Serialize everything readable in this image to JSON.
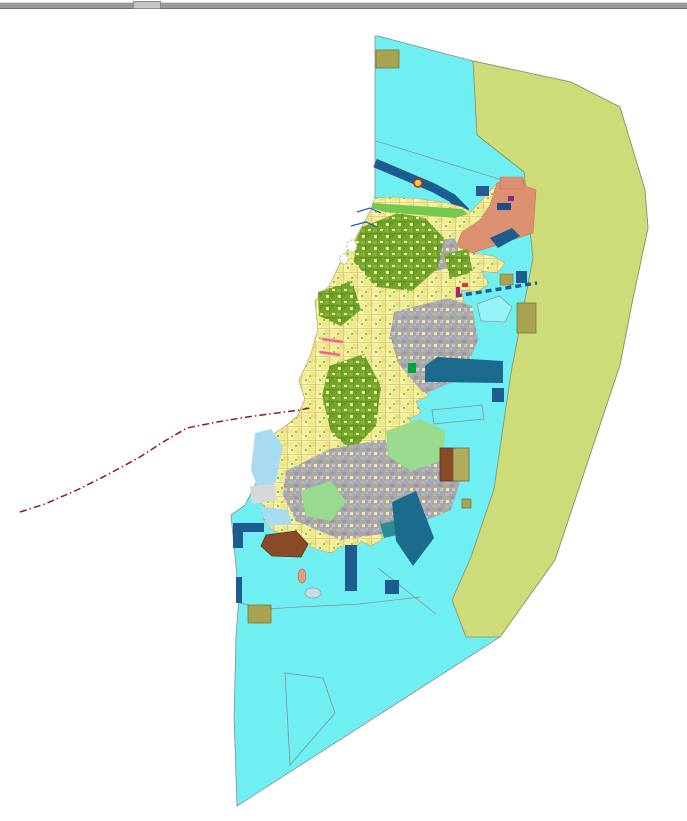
{
  "window": {
    "background": "#ffffff",
    "splitter": {
      "top": 2,
      "height": 5,
      "color": "#9a9a9a",
      "highlight": "#d8d8d8",
      "shadow": "#6f6f6f",
      "handle": {
        "x": 133,
        "width": 26,
        "color": "#c6c6c6",
        "border": "#8a8a8a"
      }
    }
  },
  "map": {
    "width": 687,
    "height": 821,
    "colors": {
      "water": "#70efF2",
      "buffer_zone": "#cdDC78",
      "parcel_yellow": "#f4f09b",
      "forest_green": "#74a62c",
      "urban_gray": "#aba6ab",
      "salmon_zone": "#db9070",
      "navy_pier": "#1d5c8e",
      "harbor_teal": "#1d6a8f",
      "khaki_block": "#a9a351",
      "brown_block": "#8a4a28",
      "light_green": "#98db8c",
      "light_blue": "#a6dbf2",
      "boundary_red": "#8b1a1a",
      "outline_gray": "#8c8c8c"
    },
    "patterns": [
      {
        "id": "parcelYellow",
        "w": 14,
        "h": 14,
        "base": "#f4f09b",
        "cells": [
          {
            "x": 0,
            "y": 0,
            "w": 7,
            "h": 5,
            "f": "#ede88e"
          },
          {
            "x": 8,
            "y": 2,
            "w": 5,
            "h": 6,
            "f": "#fbf7ad"
          },
          {
            "x": 3,
            "y": 8,
            "w": 6,
            "h": 5,
            "f": "#e8e187"
          },
          {
            "x": 10,
            "y": 9,
            "w": 4,
            "h": 4,
            "f": "#f0ec9a"
          },
          {
            "x": 0,
            "y": 6,
            "w": 14,
            "h": 0.7,
            "f": "#d9c070"
          },
          {
            "x": 7,
            "y": 0,
            "w": 0.7,
            "h": 14,
            "f": "#d9c070"
          },
          {
            "x": 11,
            "y": 1,
            "w": 2,
            "h": 2,
            "f": "#8fbb4a"
          },
          {
            "x": 1,
            "y": 11,
            "w": 2,
            "h": 2,
            "f": "#9cc258"
          }
        ]
      },
      {
        "id": "parcelGreen",
        "w": 12,
        "h": 12,
        "base": "#74a62c",
        "cells": [
          {
            "x": 1,
            "y": 1,
            "w": 4,
            "h": 3,
            "f": "#84b63a"
          },
          {
            "x": 6,
            "y": 5,
            "w": 4,
            "h": 4,
            "f": "#6a9c24"
          },
          {
            "x": 2,
            "y": 7,
            "w": 3,
            "h": 3,
            "f": "#f0ec9a"
          },
          {
            "x": 8,
            "y": 1,
            "w": 3,
            "h": 2,
            "f": "#f4f09b"
          },
          {
            "x": 0,
            "y": 5,
            "w": 12,
            "h": 0.6,
            "f": "#5e8c1e"
          },
          {
            "x": 5,
            "y": 0,
            "w": 0.6,
            "h": 12,
            "f": "#5e8c1e"
          }
        ]
      },
      {
        "id": "parcelGray",
        "w": 12,
        "h": 12,
        "base": "#aba6ab",
        "cells": [
          {
            "x": 1,
            "y": 1,
            "w": 4,
            "h": 3,
            "f": "#b8b2b8"
          },
          {
            "x": 6,
            "y": 4,
            "w": 4,
            "h": 3,
            "f": "#9c979c"
          },
          {
            "x": 2,
            "y": 8,
            "w": 3,
            "h": 3,
            "f": "#f0ec9a"
          },
          {
            "x": 8,
            "y": 8,
            "w": 3,
            "h": 3,
            "f": "#c8c2c8"
          },
          {
            "x": 6,
            "y": 0,
            "w": 2,
            "h": 2,
            "f": "#7fd0d8"
          },
          {
            "x": 0,
            "y": 6,
            "w": 2,
            "h": 2,
            "f": "#94c06a"
          }
        ]
      }
    ],
    "shapes": [
      {
        "name": "water-planning-area",
        "type": "polygon",
        "fill": "#70eff2",
        "stroke": "#8c8c8c",
        "sw": 0.8,
        "points": "378,36 473,61 571,82 620,107 645,190 648,228 632,303 620,365 555,560 500,637 237,806 234,717 236,636 239,597 231,515 245,505 259,477 266,439 283,428 297,417 305,399 299,381 311,354 318,329 315,301 330,285 341,261 357,236 371,210 375,198 375,36"
      },
      {
        "name": "coastal-buffer-zone",
        "type": "polygon",
        "fill": "#cddc78",
        "stroke": "#8a8a66",
        "sw": 0.8,
        "points": "473,61 571,82 620,107 645,190 648,228 632,303 620,365 555,560 500,637 466,637 452,600 471,557 494,489 511,373 533,258 524,172 477,135"
      },
      {
        "name": "water-zone-line-north",
        "type": "polyline",
        "fill": "none",
        "stroke": "#8c8c8c",
        "sw": 0.7,
        "points": "376,141 512,183"
      },
      {
        "name": "water-zone-line-south",
        "type": "polyline",
        "fill": "none",
        "stroke": "#8c8c8c",
        "sw": 0.7,
        "points": "240,603 266,609 300,607 360,604 420,597"
      },
      {
        "name": "water-zone-line-southeast",
        "type": "polyline",
        "fill": "none",
        "stroke": "#8c8c8c",
        "sw": 0.7,
        "points": "378,568 436,614"
      },
      {
        "name": "navigation-channel-band",
        "type": "polyline",
        "fill": "none",
        "stroke": "#1d5c8e",
        "sw": 9,
        "points": "375,163 434,188 452,198 466,212"
      },
      {
        "name": "island-parcels-base",
        "type": "polygon",
        "fill": "pattern:parcelYellow",
        "stroke": "#c8a858",
        "sw": 0.6,
        "points": "393,197 420,199 447,203 462,207 471,212 497,183 523,179 525,186 536,190 533,233 509,241 472,253 493,256 505,263 497,273 481,271 489,283 478,292 461,290 464,301 455,306 466,313 459,323 469,331 461,341 452,339 459,353 446,356 453,363 446,373 431,361 426,369 433,381 421,386 429,396 416,401 421,413 409,419 416,431 406,439 413,451 401,459 409,471 396,479 401,489 391,496 396,506 386,513 391,521 379,529 383,539 371,546 361,541 356,549 341,546 331,553 316,549 301,543 286,536 271,529 263,519 269,511 259,501 266,493 256,486 263,479 253,471 261,463 253,456 263,449 256,441 266,439 283,428 297,417 305,399 299,381 311,354 318,329 315,301 330,285 341,261 357,236 371,210 375,198"
      },
      {
        "name": "north-coast-green-strip",
        "type": "polygon",
        "fill": "#72c94e",
        "stroke": "none",
        "sw": 0,
        "points": "372,203 462,209 468,214 455,218 420,215 385,212 372,208"
      },
      {
        "name": "salmon-zone-north",
        "type": "polygon",
        "fill": "#db9070",
        "stroke": "#c07050",
        "sw": 0.5,
        "points": "497,183 523,179 525,186 536,190 533,233 509,241 472,253 456,246 462,232 480,220 490,205"
      },
      {
        "name": "salmon-zone-rect",
        "type": "rect",
        "x": 500,
        "y": 177,
        "w": 23,
        "h": 12,
        "fill": "#db9070",
        "stroke": "#c07050",
        "sw": 0.5
      },
      {
        "name": "urban-blob-north",
        "type": "polygon",
        "fill": "pattern:parcelGray",
        "stroke": "none",
        "sw": 0,
        "points": "420,243 455,238 463,264 432,272"
      },
      {
        "name": "forest-blob-northeast",
        "type": "polygon",
        "fill": "pattern:parcelGreen",
        "stroke": "none",
        "sw": 0,
        "points": "444,254 468,249 473,272 450,279"
      },
      {
        "name": "forest-mass-north",
        "type": "polygon",
        "fill": "pattern:parcelGreen",
        "stroke": "none",
        "sw": 0,
        "points": "362,227 398,213 425,218 444,238 438,268 412,291 376,287 354,262 356,240"
      },
      {
        "name": "forest-blob-midwest",
        "type": "polygon",
        "fill": "pattern:parcelGreen",
        "stroke": "none",
        "sw": 0,
        "points": "318,292 352,281 361,310 341,326 319,316"
      },
      {
        "name": "urban-mass-center",
        "type": "polygon",
        "fill": "pattern:parcelGray",
        "stroke": "none",
        "sw": 0,
        "points": "394,312 448,298 472,306 478,340 462,378 424,394 398,363 390,335"
      },
      {
        "name": "forest-mass-central",
        "type": "polygon",
        "fill": "pattern:parcelGreen",
        "stroke": "none",
        "sw": 0,
        "points": "329,366 364,354 381,386 376,426 352,451 331,432 322,396"
      },
      {
        "name": "urban-mass-south",
        "type": "polygon",
        "fill": "pattern:parcelGray",
        "stroke": "none",
        "sw": 0,
        "points": "286,471 330,449 380,440 432,441 464,470 451,510 401,531 341,540 296,521 283,495"
      },
      {
        "name": "lightgreen-blob-southeast",
        "type": "polygon",
        "fill": "#98db8c",
        "stroke": "none",
        "sw": 0,
        "points": "386,431 420,419 446,431 441,461 411,471 388,456"
      },
      {
        "name": "lightgreen-blob-southwest",
        "type": "polygon",
        "fill": "#98db8c",
        "stroke": "none",
        "sw": 0,
        "points": "301,491 331,481 346,501 331,521 306,516"
      },
      {
        "name": "lightblue-coast-west",
        "type": "polygon",
        "fill": "#a6dbf2",
        "stroke": "none",
        "sw": 0,
        "points": "255,433 271,429 283,446 276,481 263,501 251,470"
      },
      {
        "name": "lightblue-coast-west2",
        "type": "polygon",
        "fill": "#a6dbf2",
        "stroke": "none",
        "sw": 0,
        "points": "259,506 288,510 292,524 268,526"
      },
      {
        "name": "lightgray-flat-patch",
        "type": "polygon",
        "fill": "#d8d8d8",
        "stroke": "none",
        "sw": 0,
        "points": "250,486 275,484 277,500 252,504"
      },
      {
        "name": "teal-coast-patch",
        "type": "polygon",
        "fill": "#2e8b99",
        "stroke": "none",
        "sw": 0,
        "points": "380,524 398,520 402,534 384,538"
      },
      {
        "name": "brown-blob-southwest",
        "type": "polygon",
        "fill": "#8a4a28",
        "stroke": "#5a3018",
        "sw": 0.8,
        "points": "266,535 296,531 308,544 301,557 272,556 261,546"
      },
      {
        "name": "harbor-rect-east",
        "type": "polygon",
        "fill": "#1d6a8f",
        "stroke": "none",
        "sw": 0,
        "points": "437,357 503,361 503,383 425,382 425,366"
      },
      {
        "name": "harbor-square-east",
        "type": "rect",
        "x": 492,
        "y": 388,
        "w": 12,
        "h": 14,
        "fill": "#1d5c8e",
        "stroke": "none",
        "sw": 0
      },
      {
        "name": "harbor-slant-southeast",
        "type": "polygon",
        "fill": "#1d6a8f",
        "stroke": "none",
        "sw": 0,
        "points": "392,502 416,491 434,538 413,566 396,541"
      },
      {
        "name": "pier-L-horizontal",
        "type": "rect",
        "x": 233,
        "y": 523,
        "w": 31,
        "h": 9,
        "fill": "#1d5c8e",
        "stroke": "none",
        "sw": 0
      },
      {
        "name": "pier-L-vertical",
        "type": "rect",
        "x": 233,
        "y": 523,
        "w": 10,
        "h": 25,
        "fill": "#1d5c8e",
        "stroke": "none",
        "sw": 0
      },
      {
        "name": "pier-bar-west",
        "type": "rect",
        "x": 236,
        "y": 577,
        "w": 6,
        "h": 26,
        "fill": "#1d5c8e",
        "stroke": "none",
        "sw": 0
      },
      {
        "name": "pier-vertical-south",
        "type": "rect",
        "x": 345,
        "y": 545,
        "w": 12,
        "h": 46,
        "fill": "#1d5c8e",
        "stroke": "none",
        "sw": 0
      },
      {
        "name": "pier-square-south",
        "type": "rect",
        "x": 385,
        "y": 580,
        "w": 14,
        "h": 14,
        "fill": "#1d5c8e",
        "stroke": "none",
        "sw": 0
      },
      {
        "name": "navy-square-northeast1",
        "type": "rect",
        "x": 476,
        "y": 186,
        "w": 13,
        "h": 10,
        "fill": "#2b5797",
        "stroke": "none",
        "sw": 0
      },
      {
        "name": "navy-parallelogram-northeast",
        "type": "polygon",
        "fill": "#1d5c8e",
        "stroke": "none",
        "sw": 0,
        "points": "490,238 512,228 520,236 498,248"
      },
      {
        "name": "navy-strip-north-tip",
        "type": "rect",
        "x": 497,
        "y": 203,
        "w": 14,
        "h": 7,
        "fill": "#1d4e8a",
        "stroke": "none",
        "sw": 0
      },
      {
        "name": "khaki-block-top",
        "type": "rect",
        "x": 376,
        "y": 50,
        "w": 23,
        "h": 18,
        "fill": "#a9a351",
        "stroke": "#7a7436",
        "sw": 0.8
      },
      {
        "name": "khaki-block-northeast-small",
        "type": "rect",
        "x": 500,
        "y": 274,
        "w": 13,
        "h": 11,
        "fill": "#a9a351",
        "stroke": "#7a7436",
        "sw": 0.6
      },
      {
        "name": "navy-square-northeast2",
        "type": "rect",
        "x": 516,
        "y": 271,
        "w": 11,
        "h": 12,
        "fill": "#1d5c8e",
        "stroke": "none",
        "sw": 0
      },
      {
        "name": "khaki-block-east-large",
        "type": "rect",
        "x": 517,
        "y": 303,
        "w": 19,
        "h": 30,
        "fill": "#a9a351",
        "stroke": "#7a7436",
        "sw": 0.8
      },
      {
        "name": "khaki-block-southwest",
        "type": "rect",
        "x": 248,
        "y": 605,
        "w": 23,
        "h": 18,
        "fill": "#a9a351",
        "stroke": "#7a7436",
        "sw": 0.8
      },
      {
        "name": "brown-block-southeast",
        "type": "rect",
        "x": 440,
        "y": 448,
        "w": 13,
        "h": 33,
        "fill": "#8a4a28",
        "stroke": "#5a3018",
        "sw": 0.8
      },
      {
        "name": "khaki-block-southeast",
        "type": "rect",
        "x": 453,
        "y": 448,
        "w": 16,
        "h": 33,
        "fill": "#b3ac5c",
        "stroke": "#6a6a3a",
        "sw": 0.8
      },
      {
        "name": "khaki-islet-east",
        "type": "rect",
        "x": 462,
        "y": 499,
        "w": 9,
        "h": 9,
        "fill": "#a9a351",
        "stroke": "#6a6a3a",
        "sw": 0.7
      },
      {
        "name": "dashed-pier-northeast",
        "type": "line",
        "x1": 456,
        "y1": 296,
        "x2": 537,
        "y2": 283,
        "fill": "none",
        "stroke": "#1d5c8e",
        "sw": 3.5,
        "dash": "6 4"
      },
      {
        "name": "outlined-parcel-east",
        "type": "polygon",
        "fill": "rgba(255,255,255,0.25)",
        "stroke": "#8c9aa6",
        "sw": 0.8,
        "points": "477,304 499,296 512,307 505,322 481,321"
      },
      {
        "name": "outlined-quad-east",
        "type": "polygon",
        "fill": "none",
        "stroke": "#8c8c8c",
        "sw": 0.8,
        "points": "432,410 482,405 484,419 434,424"
      },
      {
        "name": "outlined-parcel-south",
        "type": "polygon",
        "fill": "none",
        "stroke": "#8c8c8c",
        "sw": 0.8,
        "points": "285,673 323,678 335,713 290,765"
      },
      {
        "name": "islet-salmon-south",
        "type": "ellipse",
        "cx": 302,
        "cy": 576,
        "rx": 4,
        "ry": 7,
        "fill": "#e0a080",
        "stroke": "#b07050",
        "sw": 0.7
      },
      {
        "name": "islet-gray-south",
        "type": "ellipse",
        "cx": 313,
        "cy": 593,
        "rx": 8,
        "ry": 5,
        "fill": "#c5dde8",
        "stroke": "#8899aa",
        "sw": 0.7
      },
      {
        "name": "stream-line-northwest1",
        "type": "polyline",
        "fill": "none",
        "stroke": "#2b4fc8",
        "sw": 1.2,
        "points": "357,212 370,208 381,213"
      },
      {
        "name": "stream-line-northwest2",
        "type": "polyline",
        "fill": "none",
        "stroke": "#2b4fc8",
        "sw": 1.2,
        "points": "351,226 366,222 377,227"
      },
      {
        "name": "islet-outline-northwest1",
        "type": "ellipse",
        "cx": 352,
        "cy": 246,
        "rx": 5,
        "ry": 6,
        "fill": "#ffffff",
        "stroke": "#999999",
        "sw": 0.8,
        "dash": "2 2"
      },
      {
        "name": "islet-outline-northwest2",
        "type": "ellipse",
        "cx": 344,
        "cy": 259,
        "rx": 4,
        "ry": 5,
        "fill": "#ffffff",
        "stroke": "#999999",
        "sw": 0.8,
        "dash": "2 2"
      },
      {
        "name": "boundary-red-dashdot",
        "type": "polyline",
        "fill": "none",
        "stroke": "#8b1a1a",
        "sw": 1.5,
        "dash": "7 3 1.5 3",
        "points": "20,512 45,504 77,490 107,475 140,457 163,442 187,428 217,422 247,417 277,413 300,410 310,408"
      },
      {
        "name": "pink-line-west1",
        "type": "line",
        "x1": 322,
        "y1": 339,
        "x2": 343,
        "y2": 342,
        "fill": "none",
        "stroke": "#f06292",
        "sw": 2.5
      },
      {
        "name": "pink-line-west2",
        "type": "line",
        "x1": 320,
        "y1": 352,
        "x2": 340,
        "y2": 355,
        "fill": "none",
        "stroke": "#f06292",
        "sw": 2.5
      },
      {
        "name": "buoy-marker-north",
        "type": "circle",
        "cx": 418,
        "cy": 183,
        "r": 4,
        "fill": "#e8d44c",
        "stroke": "#cc2200",
        "sw": 1.5
      },
      {
        "name": "magenta-mark-east",
        "type": "rect",
        "x": 456,
        "y": 287,
        "w": 4,
        "h": 9,
        "fill": "#c2186b",
        "stroke": "none",
        "sw": 0
      },
      {
        "name": "red-mark-east",
        "type": "rect",
        "x": 462,
        "y": 283,
        "w": 6,
        "h": 4,
        "fill": "#e03030",
        "stroke": "none",
        "sw": 0
      },
      {
        "name": "purple-mark-north",
        "type": "rect",
        "x": 508,
        "y": 196,
        "w": 6,
        "h": 5,
        "fill": "#7b2d8e",
        "stroke": "none",
        "sw": 0
      },
      {
        "name": "green-mark-east",
        "type": "rect",
        "x": 408,
        "y": 363,
        "w": 8,
        "h": 10,
        "fill": "#00a43c",
        "stroke": "none",
        "sw": 0
      }
    ]
  }
}
